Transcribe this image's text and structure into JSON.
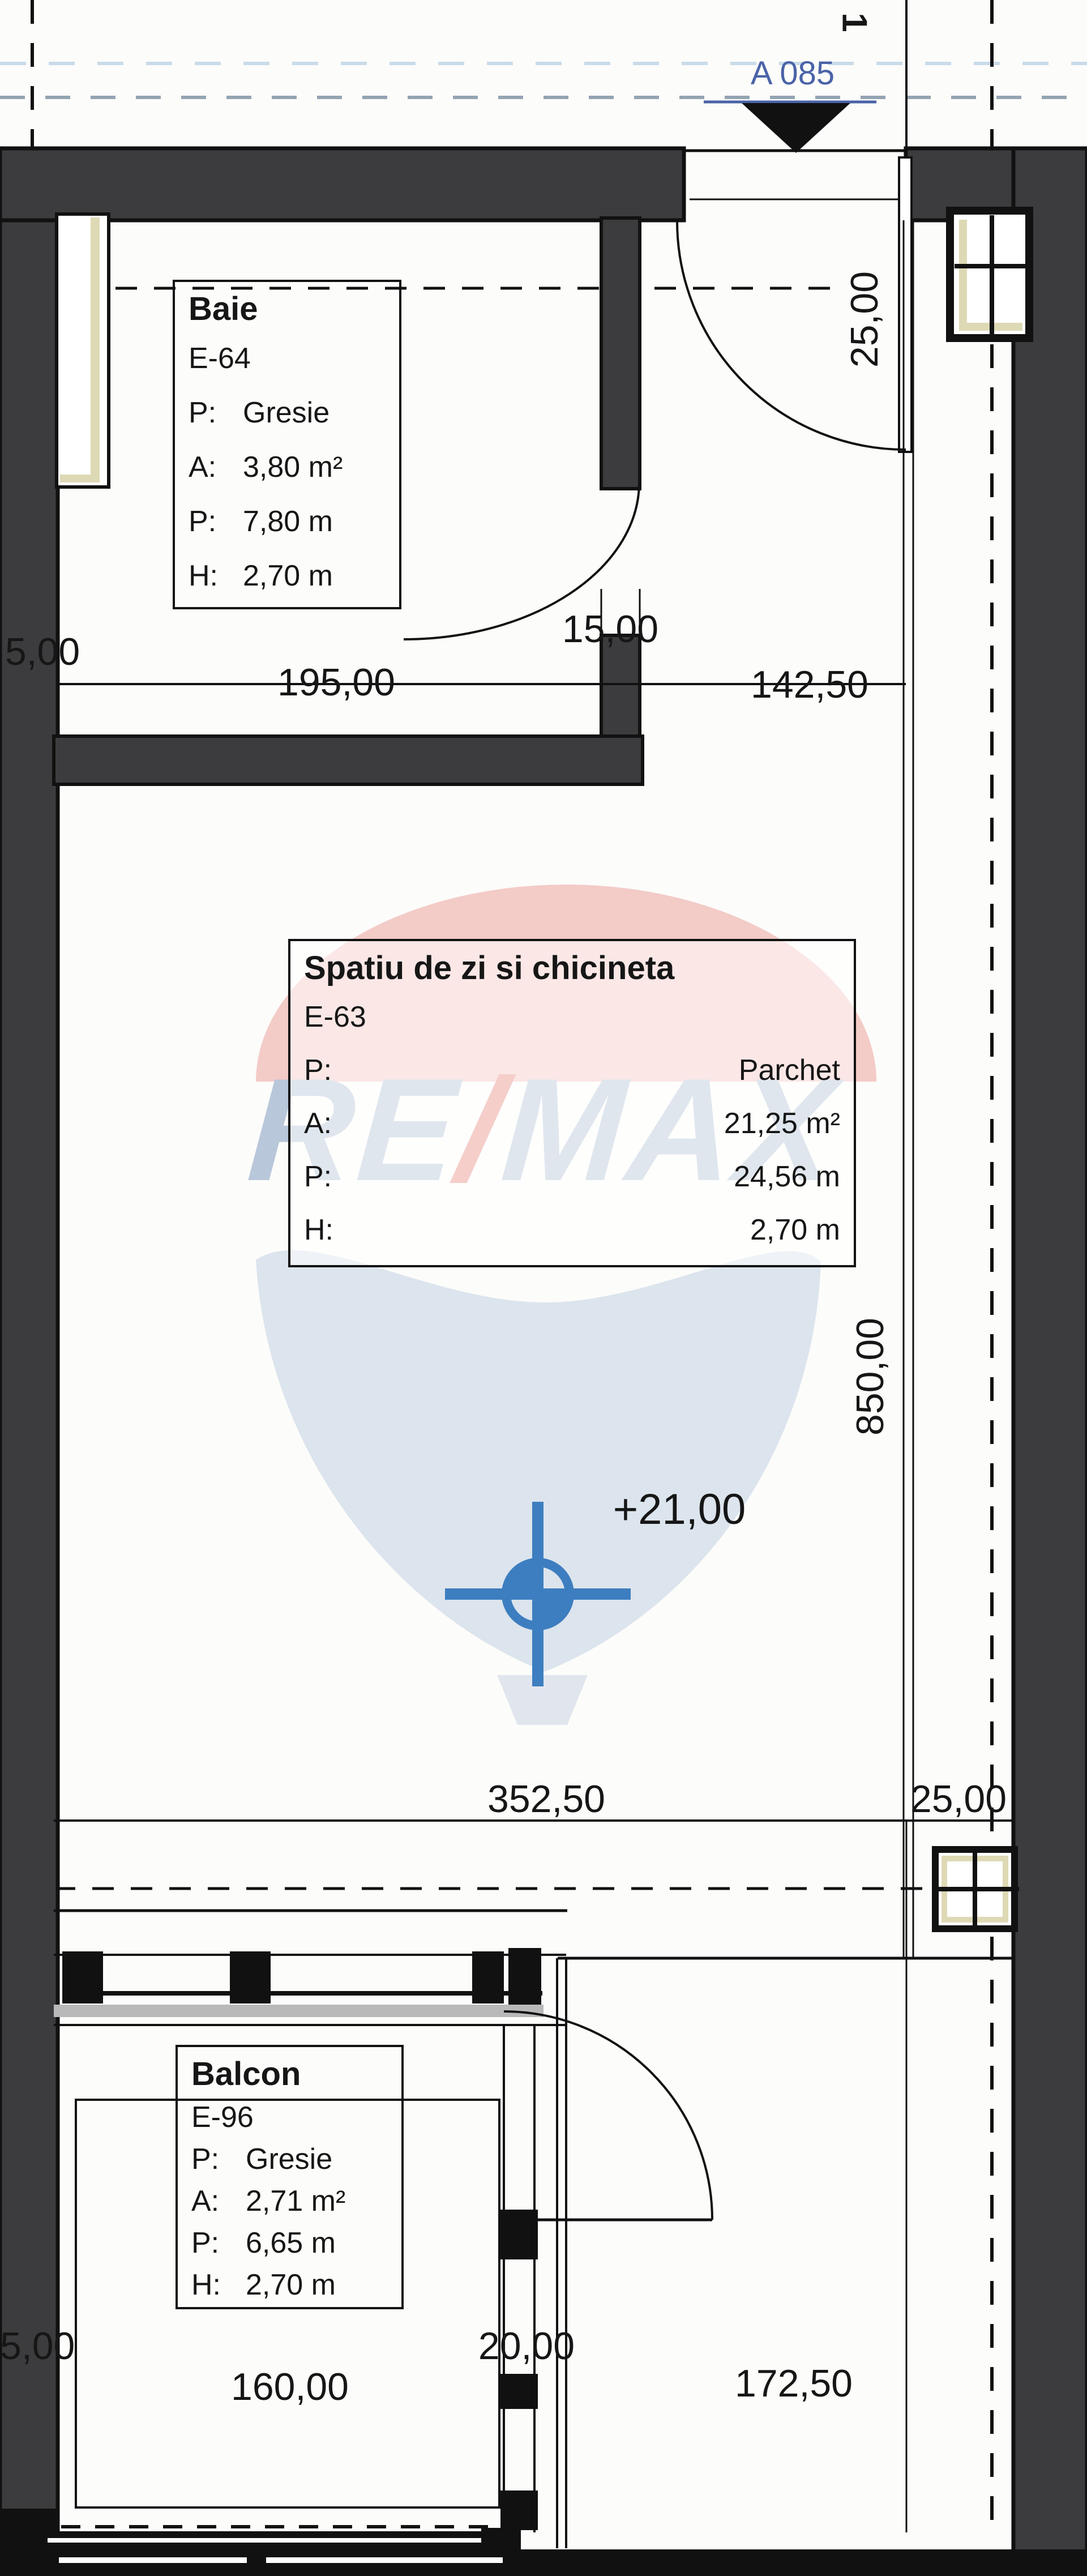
{
  "header": {
    "section_label": "A 085",
    "grid_label": "1"
  },
  "rooms": {
    "baie": {
      "title": "Baie",
      "code": "E-64",
      "rows": [
        [
          "P:",
          "Gresie"
        ],
        [
          "A:",
          "3,80 m²"
        ],
        [
          "P:",
          "7,80 m"
        ],
        [
          "H:",
          "2,70 m"
        ]
      ]
    },
    "living": {
      "title": "Spatiu de zi si chicineta",
      "code": "E-63",
      "rows": [
        [
          "P:",
          "Parchet"
        ],
        [
          "A:",
          "21,25 m²"
        ],
        [
          "P:",
          "24,56 m"
        ],
        [
          "H:",
          "2,70 m"
        ]
      ]
    },
    "balcon": {
      "title": "Balcon",
      "code": "E-96",
      "rows": [
        [
          "P:",
          "Gresie"
        ],
        [
          "A:",
          "2,71 m²"
        ],
        [
          "P:",
          "6,65 m"
        ],
        [
          "H:",
          "2,70 m"
        ]
      ]
    }
  },
  "dimensions": {
    "d5_top": "5,00",
    "d195": "195,00",
    "d15": "15,00",
    "d14250": "142,50",
    "d25_top": "25,00",
    "d850": "850,00",
    "d35250": "352,50",
    "d25_mid": "25,00",
    "d5_bot": "5,00",
    "d160": "160,00",
    "d20": "20,00",
    "d17250": "172,50"
  },
  "level_marker": "+21,00",
  "watermark": {
    "re": "RE",
    "slash": "/",
    "max": "MAX"
  },
  "colors": {
    "wall": "#3c3c3e",
    "line": "#111111",
    "window_frame_tan": "#ded9b5",
    "section_blue": "#4a63a8",
    "marker_blue": "#3d7ec0",
    "balloon_pink": "#f3cbc7",
    "balloon_body": "#dce4ed"
  }
}
